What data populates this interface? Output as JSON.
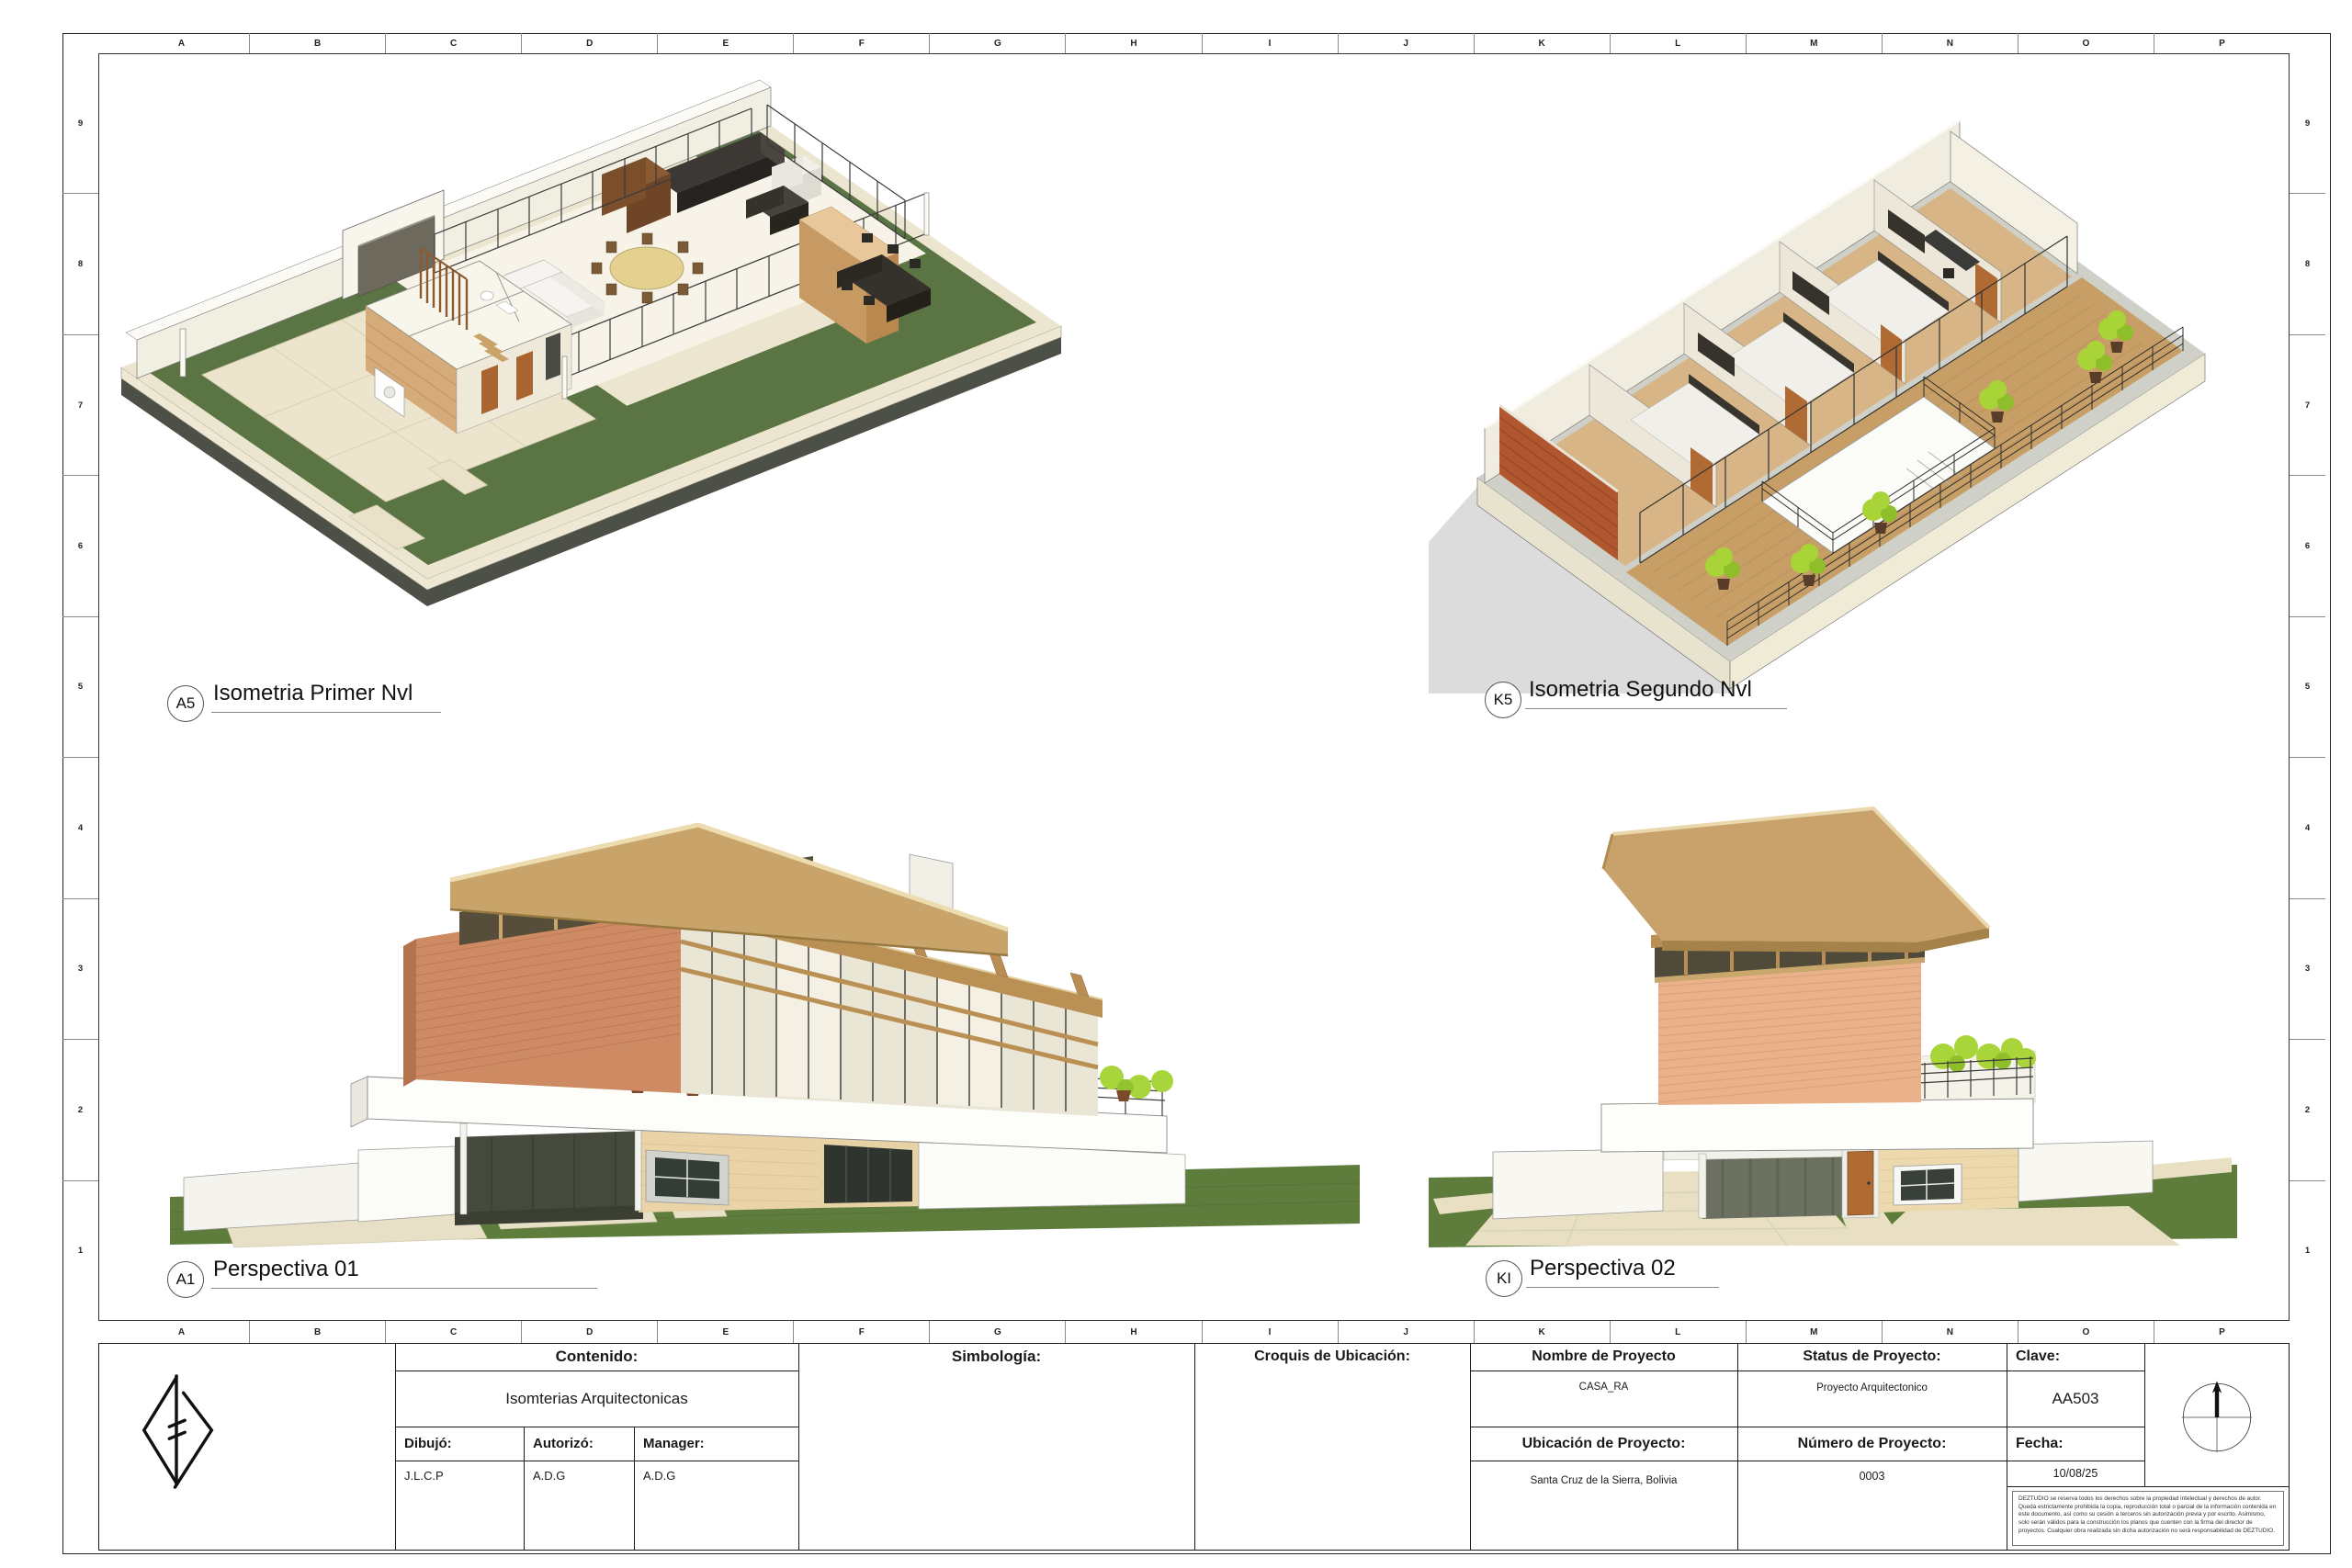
{
  "grid": {
    "columns": [
      "A",
      "B",
      "C",
      "D",
      "E",
      "F",
      "G",
      "H",
      "I",
      "J",
      "K",
      "L",
      "M",
      "N",
      "O",
      "P"
    ],
    "rows": [
      "9",
      "8",
      "7",
      "6",
      "5",
      "4",
      "3",
      "2",
      "1"
    ]
  },
  "views": [
    {
      "tag": "A5",
      "title": "Isometria Primer Nvl"
    },
    {
      "tag": "K5",
      "title": "Isometria Segundo Nvl"
    },
    {
      "tag": "A1",
      "title": "Perspectiva 01"
    },
    {
      "tag": "KI",
      "title": "Perspectiva 02"
    }
  ],
  "titleblock": {
    "contenido": {
      "label": "Contenido:",
      "value": "Isomterias Arquitectonicas"
    },
    "simbologia": {
      "label": "Simbología:"
    },
    "croquis": {
      "label": "Croquis de Ubicación:"
    },
    "dibujo": {
      "label": "Dibujó:",
      "value": "J.L.C.P"
    },
    "autorizo": {
      "label": "Autorizó:",
      "value": "A.D.G"
    },
    "manager": {
      "label": "Manager:",
      "value": "A.D.G"
    },
    "nombre": {
      "label": "Nombre de Proyecto",
      "value": "CASA_RA"
    },
    "status": {
      "label": "Status de Proyecto:",
      "value": "Proyecto Arquitectonico"
    },
    "clave": {
      "label": "Clave:",
      "value": "AA503"
    },
    "ubicacion": {
      "label": "Ubicación de Proyecto:",
      "value": "Santa Cruz de la Sierra, Bolivia"
    },
    "numero": {
      "label": "Número de Proyecto:",
      "value": "0003"
    },
    "fecha": {
      "label": "Fecha:",
      "value": "10/08/25"
    },
    "disclaimer": "DEZTUDIO se reserva todos los derechos sobre la propiedad intelectual y derechos de autor. Queda estrictamente prohibida la copia, reproducción total o parcial de la información contenida en este documento, así como su cesión a terceros sin autorización previa y por escrito. Asimismo, solo serán válidos para la construcción los planos que cuenten con la firma del director de proyectos. Cualquier obra realizada sin dicha autorización no será responsabilidad de DEZTUDIO."
  },
  "colors": {
    "grass": "#5e7c3c",
    "brick_render": "#cd8a63",
    "terracotta_wall": "#b0572f",
    "roof_tan": "#c8a26a",
    "deck_wood": "#c79f66",
    "plant_lime": "#a9d43a",
    "paper": "#ffffff",
    "line": "#1a1a1a"
  }
}
